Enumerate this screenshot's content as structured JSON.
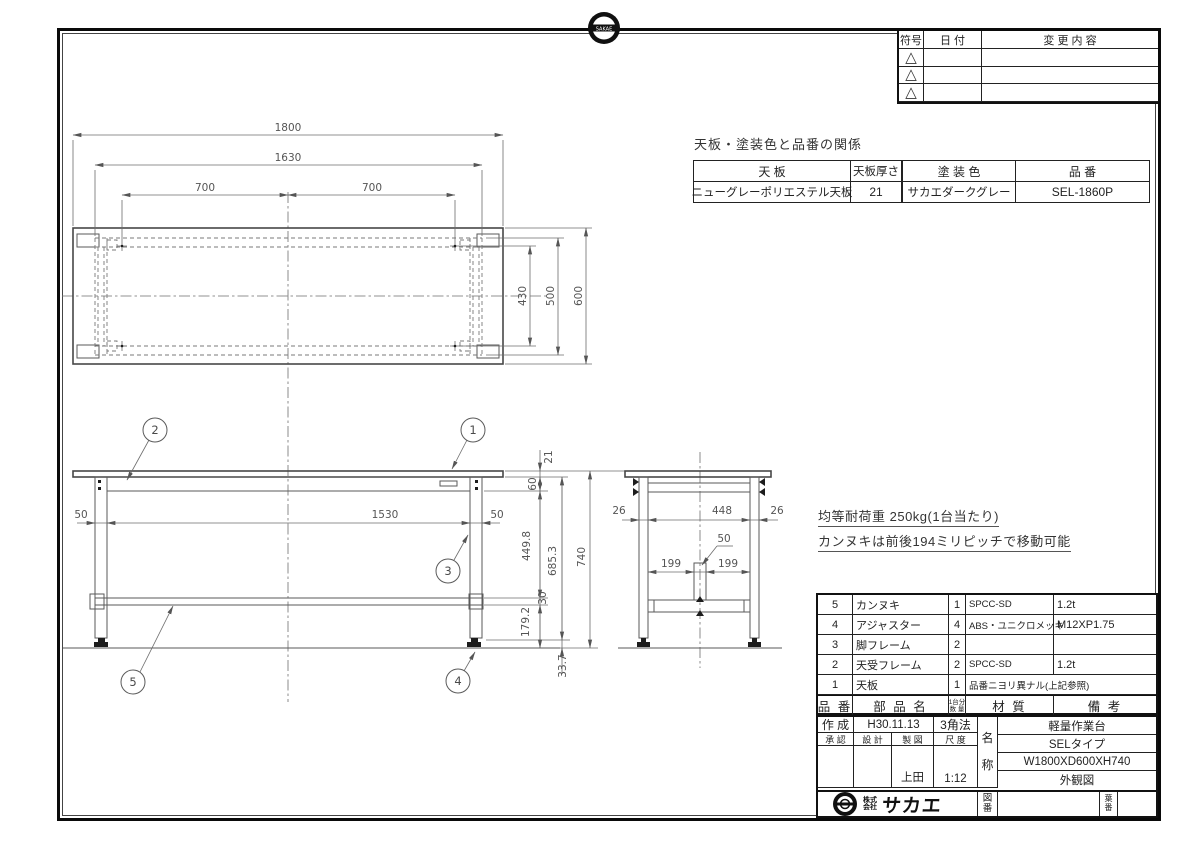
{
  "stamp": {
    "text": "SAKAE"
  },
  "revision": {
    "headers": [
      "符号",
      "日 付",
      "変 更 内 容"
    ],
    "marker": "△"
  },
  "finish": {
    "title": "天板・塗装色と品番の関係",
    "headers": [
      "天 板",
      "天板厚さ",
      "塗 装 色",
      "品 番"
    ],
    "row": {
      "top": "ニューグレーポリエステル天板",
      "thickness": "21",
      "color": "サカエダークグレー",
      "part_no": "SEL-1860P"
    }
  },
  "notes": {
    "line1": "均等耐荷重 250kg(1台当たり)",
    "line2": "カンヌキは前後194ミリピッチで移動可能"
  },
  "parts": {
    "header": {
      "no": "品 番",
      "name": "部 品 名",
      "qty_top": "1台分",
      "qty_bottom": "数 量",
      "material": "材 質",
      "remarks": "備 考"
    },
    "rows": [
      {
        "no": "5",
        "name": "カンヌキ",
        "qty": "1",
        "material": "SPCC-SD",
        "remarks": "1.2t"
      },
      {
        "no": "4",
        "name": "アジャスター",
        "qty": "4",
        "material": "ABS・ユニクロメッキ",
        "remarks": "M12XP1.75"
      },
      {
        "no": "3",
        "name": "脚フレーム",
        "qty": "2",
        "material": "",
        "remarks": ""
      },
      {
        "no": "2",
        "name": "天受フレーム",
        "qty": "2",
        "material": "SPCC-SD",
        "remarks": "1.2t"
      },
      {
        "no": "1",
        "name": "天板",
        "qty": "1",
        "material": "品番ニヨリ異ナル(上記参照)",
        "remarks": ""
      }
    ]
  },
  "title_block": {
    "created_label": "作 成",
    "created_date": "H30.11.13",
    "projection": "3角法",
    "sign_headers": [
      "承 認",
      "設 計",
      "製 図",
      "尺 度"
    ],
    "drafter": "上田",
    "scale": "1:12",
    "name_label": [
      "名",
      "称"
    ],
    "names": [
      "軽量作業台",
      "SELタイプ",
      "W1800XD600XH740",
      "外観図"
    ],
    "drawing_no_label": [
      "図",
      "番"
    ],
    "sheet_no_label": [
      "葉",
      "番"
    ],
    "company_prefix": [
      "株式",
      "会社"
    ],
    "brand": "サカエ"
  },
  "dims": {
    "top": {
      "w": "1800",
      "frame_w": "1630",
      "pitch_left": "700",
      "pitch_right": "700",
      "bolt_span": "430",
      "frame_d": "500",
      "d": "600"
    },
    "front": {
      "left_leg": "50",
      "inner": "1530",
      "right_leg": "50",
      "top_thickness": "21",
      "rail_h": "60",
      "leg_upper": "449.8",
      "bar_h": "30",
      "leg_lower": "179.2",
      "under_height": "685.3",
      "total_h": "740",
      "foot_h": "33.7"
    },
    "side": {
      "left": "26",
      "inner": "448",
      "right": "26",
      "bar_w": "50",
      "pitch_left": "199",
      "pitch_right": "199"
    }
  },
  "balloons": {
    "b1": "1",
    "b2": "2",
    "b3": "3",
    "b4": "4",
    "b5": "5"
  }
}
